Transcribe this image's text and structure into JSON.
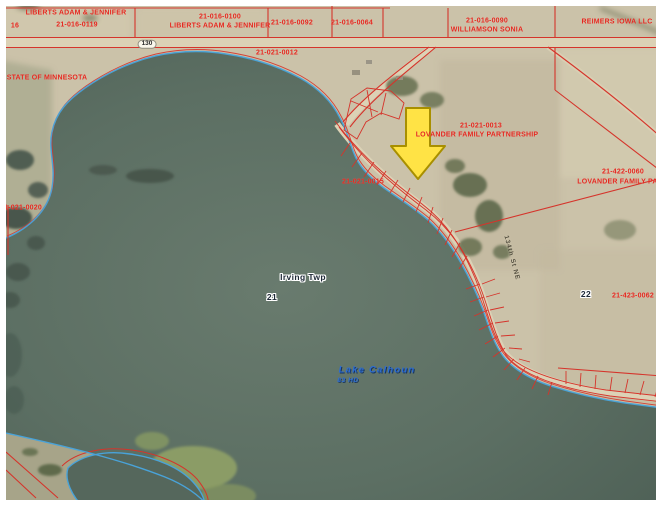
{
  "map": {
    "type": "aerial-parcel-map",
    "place": {
      "township": "Irving Twp",
      "sections": [
        "21",
        "22"
      ],
      "lake_name": "Lake Calhoun",
      "lake_id": "83 HD",
      "road_shield": "130",
      "road_name": "134th St NE"
    },
    "marker": {
      "type": "down-arrow",
      "color": "#ffe345"
    },
    "colors": {
      "parcel_line": "#d5342b",
      "parcel_label": "#e5271f",
      "shoreline": "#49a3d9",
      "water": "#5b6e63",
      "land": "#cbc2a9",
      "road": "#dbd1b5",
      "lake_label": "#2b6cd4",
      "arrow": "#ffe345",
      "frame": "#ffffff"
    },
    "labels": [
      {
        "name": "owner-liberts-1",
        "text": "LIBERTS ADAM & JENNIFER",
        "x": 76,
        "y": 13,
        "cls": "red"
      },
      {
        "name": "section-16",
        "text": "16",
        "x": 15,
        "y": 26,
        "cls": "red"
      },
      {
        "name": "parcel-21-016-0119",
        "text": "21-016-0119",
        "x": 77,
        "y": 25,
        "cls": "red"
      },
      {
        "name": "parcel-21-016-0100",
        "text": "21-016-0100",
        "x": 220,
        "y": 17,
        "cls": "red"
      },
      {
        "name": "owner-liberts-2",
        "text": "LIBERTS ADAM & JENNIFER",
        "x": 220,
        "y": 26,
        "cls": "red"
      },
      {
        "name": "parcel-21-016-0092",
        "text": "21-016-0092",
        "x": 292,
        "y": 23,
        "cls": "red"
      },
      {
        "name": "parcel-21-016-0064",
        "text": "21-016-0064",
        "x": 352,
        "y": 23,
        "cls": "red"
      },
      {
        "name": "parcel-21-016-0090",
        "text": "21-016-0090",
        "x": 487,
        "y": 21,
        "cls": "red"
      },
      {
        "name": "owner-williamson",
        "text": "WILLIAMSON SONIA",
        "x": 487,
        "y": 30,
        "cls": "red"
      },
      {
        "name": "owner-reimers",
        "text": "REIMERS IOWA LLC",
        "x": 617,
        "y": 22,
        "cls": "red"
      },
      {
        "name": "parcel-21-021-0012",
        "text": "21-021-0012",
        "x": 277,
        "y": 53,
        "cls": "red"
      },
      {
        "name": "owner-state-mn",
        "text": "STATE OF MINNESOTA",
        "x": 47,
        "y": 78,
        "cls": "red"
      },
      {
        "name": "parcel-21-021-0013",
        "text": "21-021-0013",
        "x": 481,
        "y": 126,
        "cls": "red"
      },
      {
        "name": "owner-lovander-1",
        "text": "LOVANDER FAMILY PARTNERSHIP",
        "x": 477,
        "y": 135,
        "cls": "red"
      },
      {
        "name": "parcel-21-021-0015",
        "text": "21-021-0015",
        "x": 363,
        "y": 182,
        "cls": "red"
      },
      {
        "name": "parcel-21-422-0060",
        "text": "21-422-0060",
        "x": 623,
        "y": 172,
        "cls": "red"
      },
      {
        "name": "owner-lovander-2",
        "text": "LOVANDER FAMILY PARTNER",
        "x": 630,
        "y": 182,
        "cls": "red"
      },
      {
        "name": "parcel-21-021-0020",
        "text": "21-021-0020",
        "x": 21,
        "y": 208,
        "cls": "red"
      },
      {
        "name": "township-label",
        "text": "Irving Twp",
        "x": 303,
        "y": 277,
        "cls": "place"
      },
      {
        "name": "section-21",
        "text": "21",
        "x": 272,
        "y": 297,
        "cls": "place"
      },
      {
        "name": "section-22",
        "text": "22",
        "x": 586,
        "y": 294,
        "cls": "place"
      },
      {
        "name": "parcel-21-423-0062",
        "text": "21-423-0062",
        "x": 633,
        "y": 296,
        "cls": "red"
      },
      {
        "name": "lake-name",
        "text": "Lake Calhoun",
        "x": 377,
        "y": 370,
        "cls": "lake"
      },
      {
        "name": "lake-id",
        "text": "83 HD",
        "x": 348,
        "y": 381,
        "cls": "lake-sm"
      },
      {
        "name": "road-name",
        "text": "134th St NE",
        "x": 511,
        "y": 258,
        "cls": "road",
        "rotate": 75
      },
      {
        "name": "highway-shield",
        "text": "130",
        "x": 147,
        "y": 44,
        "cls": "shield"
      }
    ]
  }
}
